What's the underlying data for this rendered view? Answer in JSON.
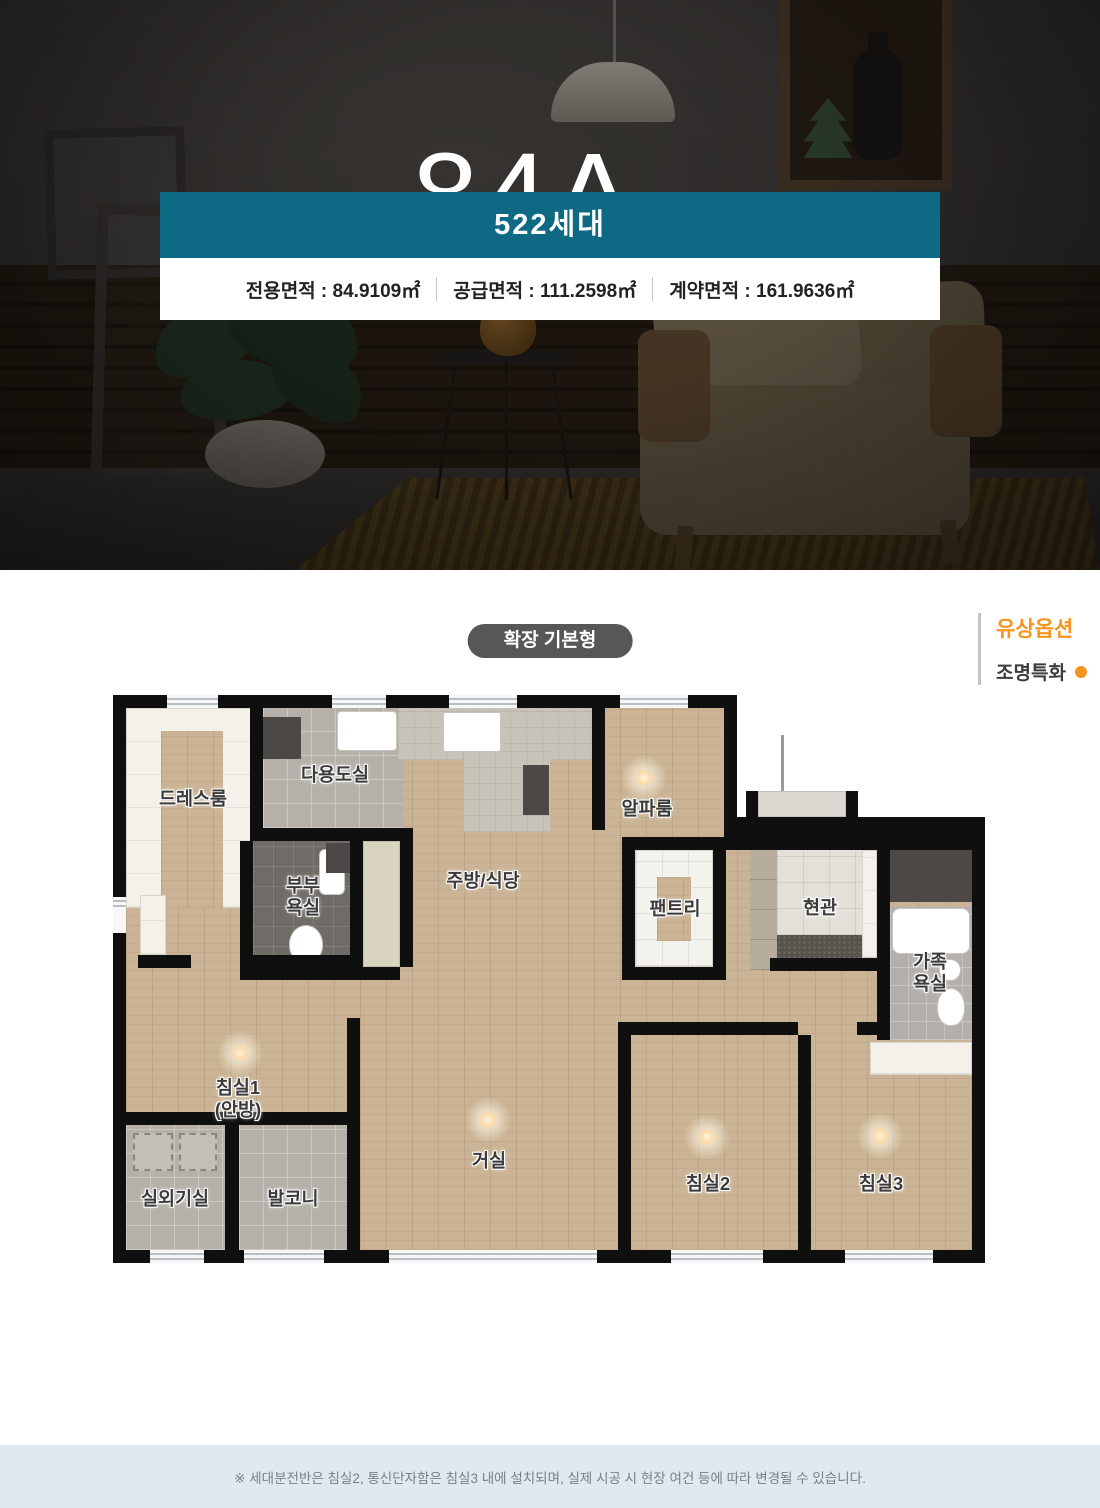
{
  "hero": {
    "title": "84A",
    "unit": "㎡",
    "badge": "522세대",
    "areas": [
      "전용면적 : 84.9109㎡",
      "공급면적 : 111.2598㎡",
      "계약면적 : 161.9636㎡"
    ]
  },
  "options": {
    "pill": "확장 기본형",
    "paid_option_title": "유상옵션",
    "paid_option_item": "조명특화"
  },
  "plan": {
    "labels": {
      "dress": "드레스룸",
      "utility": "다용도실",
      "master_bath": "부부\n욕실",
      "kitchen": "주방/식당",
      "alpha": "알파룸",
      "pantry": "팬트리",
      "entry": "현관",
      "family_bath": "가족\n욕실",
      "bed1": "침실1\n(안방)",
      "living": "거실",
      "bed2": "침실2",
      "bed3": "침실3",
      "outdoor": "실외기실",
      "balcony": "발코니"
    }
  },
  "colors": {
    "accent_teal": "#0e6984",
    "accent_orange": "#f6941e"
  },
  "footer": {
    "note": "※ 세대분전반은 침실2, 통신단자함은 침실3 내에 설치되며, 실제 시공 시 현장 여건 등에 따라 변경될 수 있습니다."
  }
}
